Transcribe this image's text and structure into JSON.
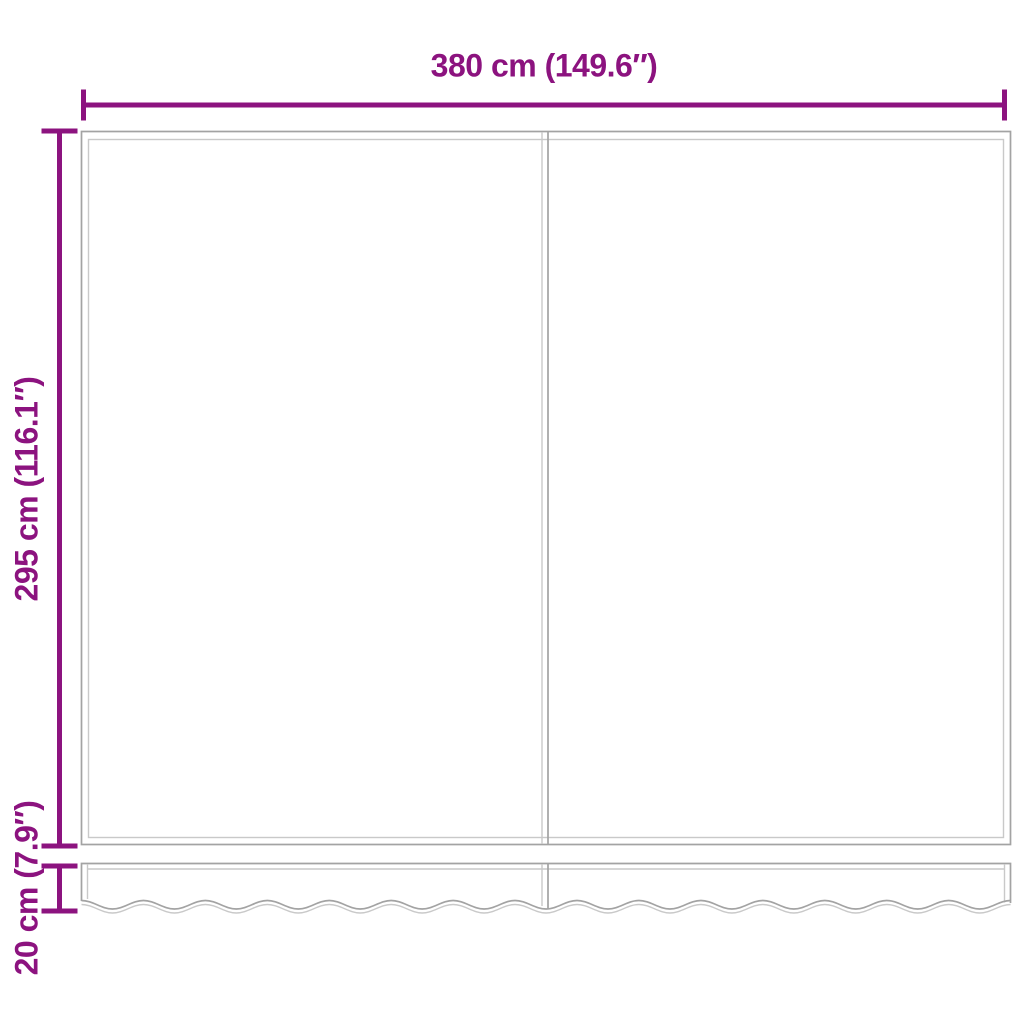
{
  "diagram": {
    "labels": {
      "width": "380 cm (149.6″)",
      "height": "295 cm (116.1″)",
      "valance_height": "20 cm (7.9″)"
    },
    "colors": {
      "dimension_accent": "#8C137F",
      "outline_gray": "#A3A3A3",
      "outline_light_gray": "#C9C9C9",
      "background": "#FFFFFF"
    }
  }
}
